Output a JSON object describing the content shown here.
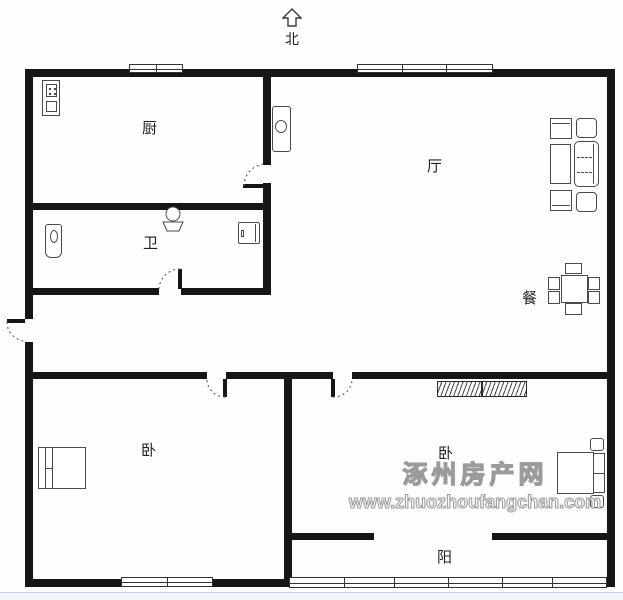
{
  "compass": {
    "label": "北"
  },
  "rooms": {
    "kitchen": "厨",
    "living": "厅",
    "bath": "卫",
    "dining": "餐",
    "bedroom_left": "卧",
    "bedroom_right": "卧",
    "balcony": "阳"
  },
  "watermark": {
    "line1": "涿州房产网",
    "line2": "www.zhuozhoufangchan.com"
  },
  "icons": {
    "north_arrow": "hollow-up-arrow",
    "stove": "two-burner-stove",
    "fridge": "refrigerator",
    "toilet": "toilet",
    "basin": "wash-basin",
    "washer": "washing-machine",
    "sofa_set": "sofa-group-with-tables",
    "dining_set": "square-table-six-chairs",
    "wardrobe": "wardrobe-with-hangers",
    "bed": "double-bed"
  },
  "colors": {
    "wall": "#161616",
    "line": "#4a4a4a",
    "winb": "#333333",
    "label": "#222222",
    "wmfill": "#f8f8f8",
    "wmstroke": "#9b9b9b",
    "stripbg": "#f1f4fb",
    "stripline": "#c9d3e8"
  }
}
